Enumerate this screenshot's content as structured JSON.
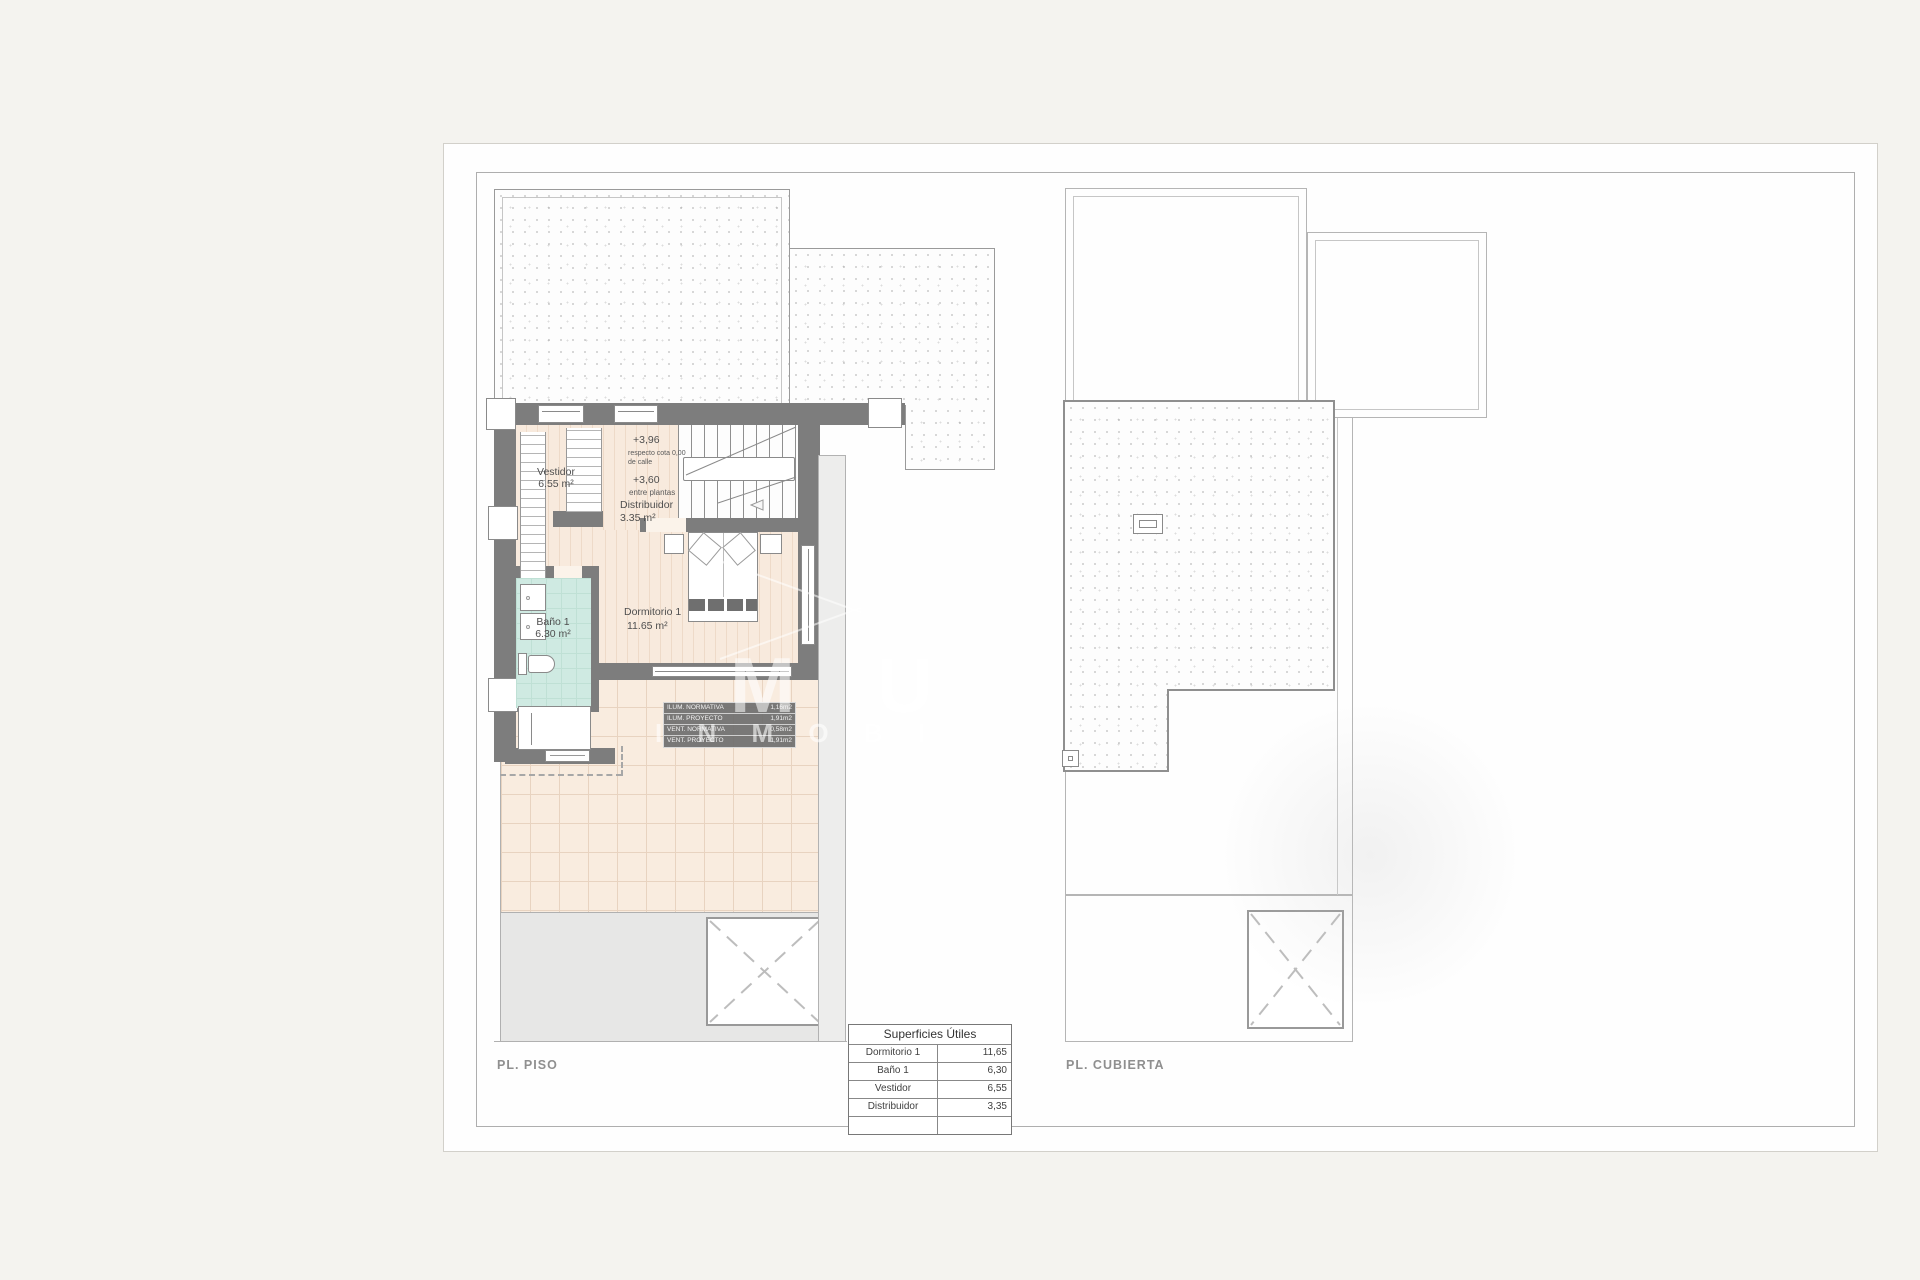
{
  "sheet": {
    "plan_piso_label": "PL. PISO",
    "plan_cubierta_label": "PL. CUBIERTA"
  },
  "rooms": {
    "vestidor": {
      "name": "Vestidor",
      "area": "6.55 m²"
    },
    "distribuidor": {
      "name": "Distribuidor",
      "area": "3.35 m²"
    },
    "bano": {
      "name": "Baño 1",
      "area": "6.30 m²"
    },
    "dormitorio": {
      "name": "Dormitorio 1",
      "area": "11.65 m²"
    }
  },
  "elevations": {
    "upper": "+3,96",
    "upper_note_line1": "respecto cota 0,00",
    "upper_note_line2": "de calle",
    "mid": "+3,60",
    "mid_note": "entre plantas"
  },
  "vent_table": {
    "rows": [
      {
        "label": "ILUM. NORMATIVA",
        "value": "1,16m2"
      },
      {
        "label": "ILUM. PROYECTO",
        "value": "1,91m2"
      },
      {
        "label": "VENT. NORMATIVA",
        "value": "0,58m2"
      },
      {
        "label": "VENT. PROYECTO",
        "value": "1,91m2"
      }
    ]
  },
  "surfaces_table": {
    "title": "Superficies Útiles",
    "rows": [
      {
        "label": "Dormitorio 1",
        "value": "11,65"
      },
      {
        "label": "Baño 1",
        "value": "6,30"
      },
      {
        "label": "Vestidor",
        "value": "6,55"
      },
      {
        "label": "Distribuidor",
        "value": "3,35"
      }
    ]
  },
  "watermark": {
    "letters": "M U",
    "text": "I N M O B I"
  },
  "colors": {
    "wall": "#7d7d7d",
    "floor_peach": "#f8eadd",
    "floor_teal": "#cfeae2",
    "patio_gray": "#e7e7e6"
  }
}
